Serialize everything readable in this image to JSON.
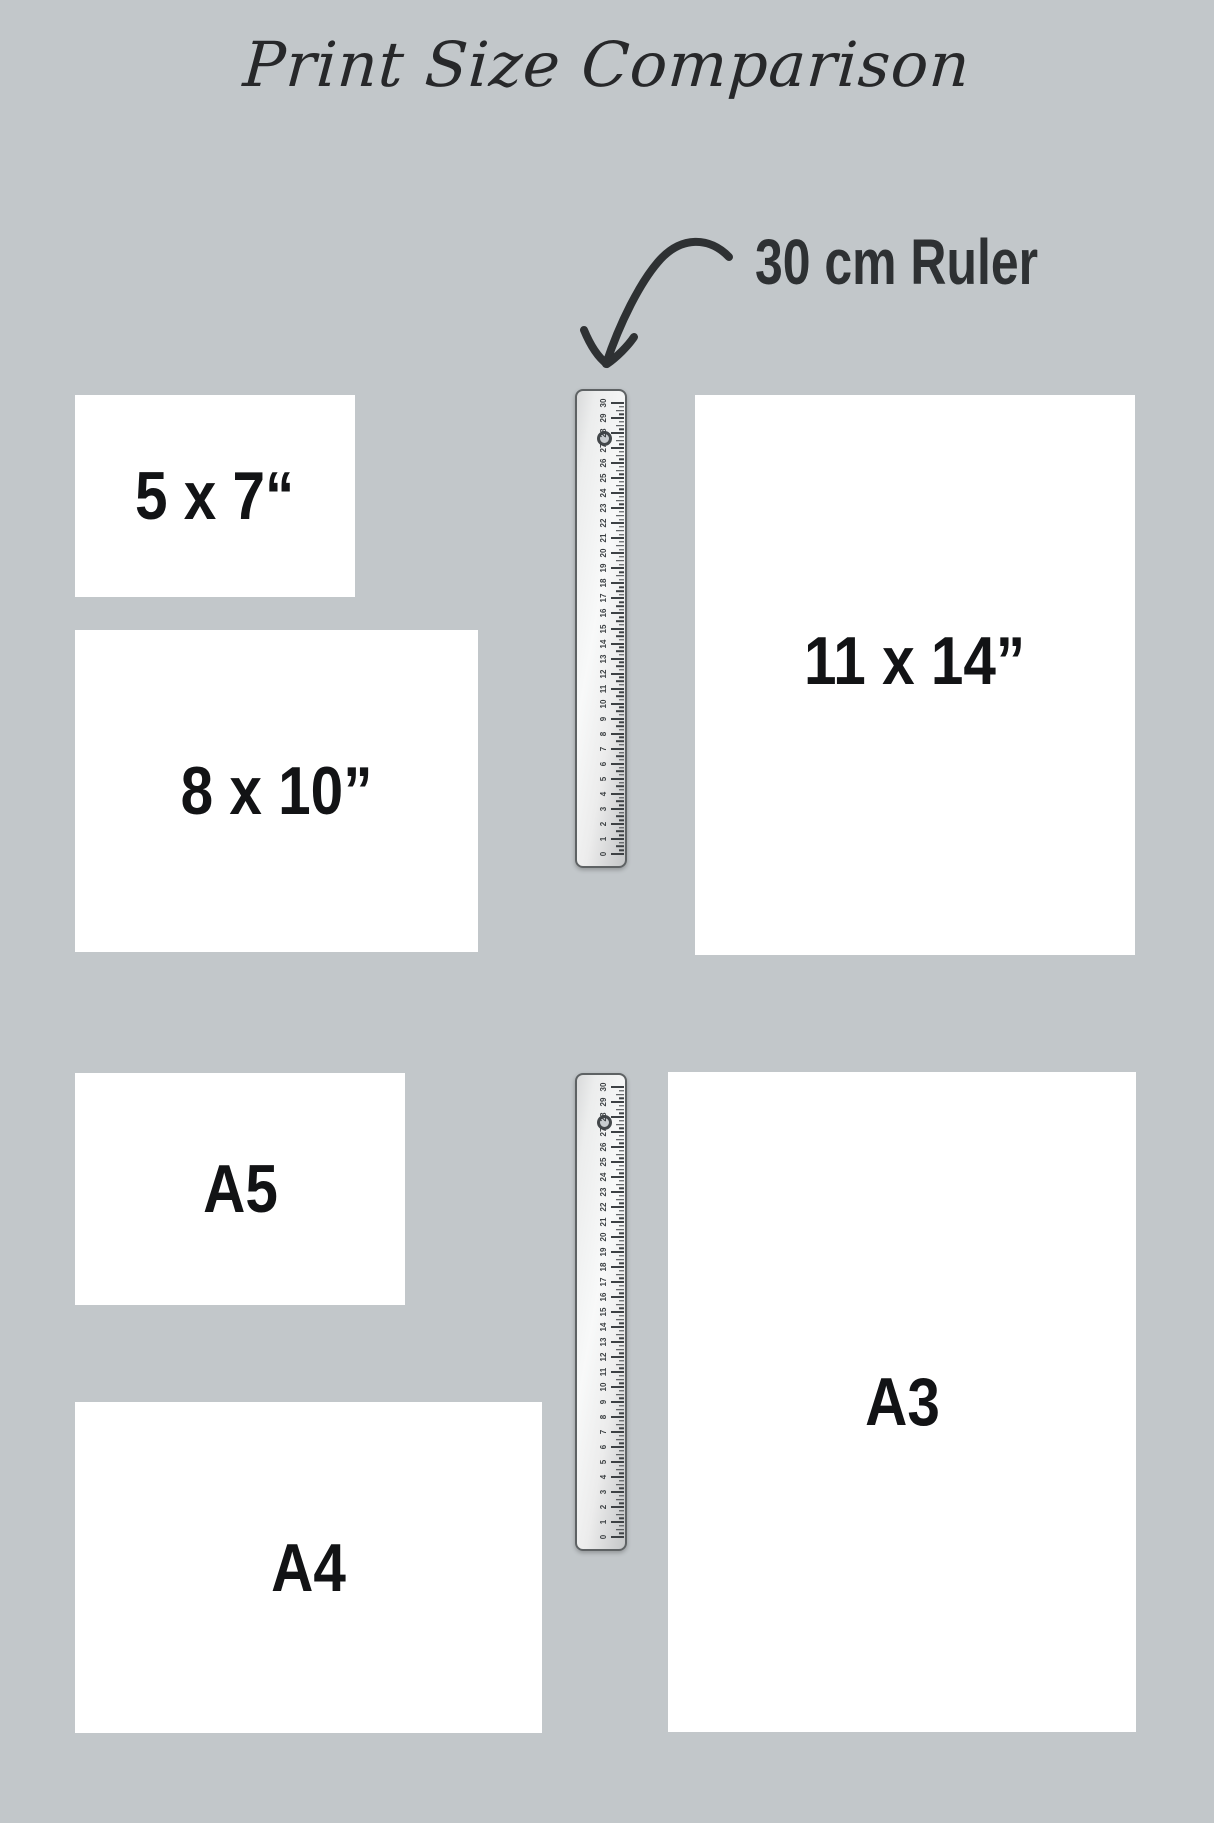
{
  "page": {
    "title": "Print Size Comparison",
    "background_color": "#c2c7ca",
    "text_color": "#121315",
    "accent_color": "#2e3133"
  },
  "annotation": {
    "ruler_label": "30 cm Ruler"
  },
  "sizes": [
    {
      "id": "5x7",
      "label": "5 x 7“"
    },
    {
      "id": "8x10",
      "label": "8 x 10”"
    },
    {
      "id": "11x14",
      "label": "11 x 14”"
    },
    {
      "id": "a5",
      "label": "A5"
    },
    {
      "id": "a4",
      "label": "A4"
    },
    {
      "id": "a3",
      "label": "A3"
    }
  ],
  "ruler": {
    "length_cm": 30,
    "numbers": [
      "0",
      "1",
      "2",
      "3",
      "4",
      "5",
      "6",
      "7",
      "8",
      "9",
      "10",
      "11",
      "12",
      "13",
      "14",
      "15",
      "16",
      "17",
      "18",
      "19",
      "20",
      "21",
      "22",
      "23",
      "24",
      "25",
      "26",
      "27",
      "28",
      "29",
      "30"
    ]
  }
}
